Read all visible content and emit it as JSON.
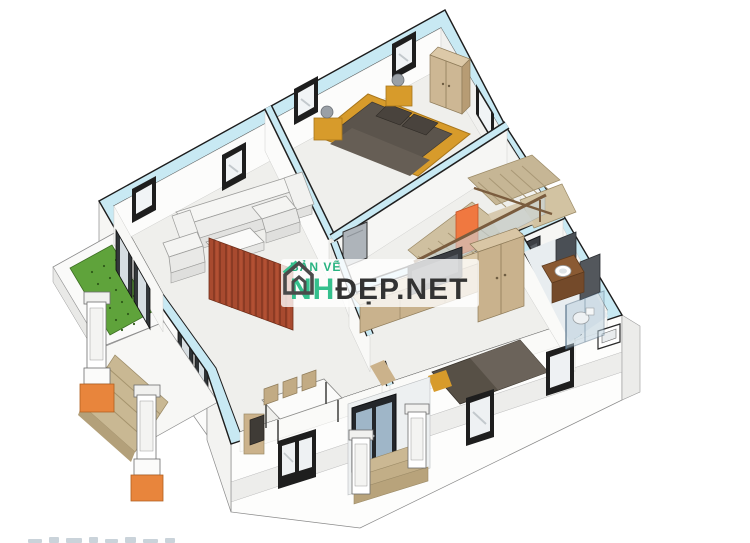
{
  "page": {
    "description": "3D isometric rendering of a house floor plan with watermark",
    "background": "#ffffff"
  },
  "watermark": {
    "top_label": "BẢN VẼ",
    "brand_green": "NH",
    "brand_dark": "ĐẸP.NET",
    "green_color": "#35c08d",
    "dark_color": "#333333"
  },
  "palette": {
    "wall_top_band": "#c8e9f3",
    "wall_edge": "#1c1c1c",
    "floor": "#efefec",
    "bed_frame_yellow": "#d79b2b",
    "mattress_dark": "#5b544c",
    "wood_tan": "#c9b28d",
    "wood_tan_dark": "#b79c74",
    "stair_tread": "#cfc0a0",
    "stair_accent_orange": "#f07840",
    "partition_red": "#a84a2f",
    "grass_green": "#5fa33b",
    "column_base_orange": "#e8853c",
    "glass_blue": "#b9cfdd",
    "vanity_brown": "#8a5a33"
  }
}
